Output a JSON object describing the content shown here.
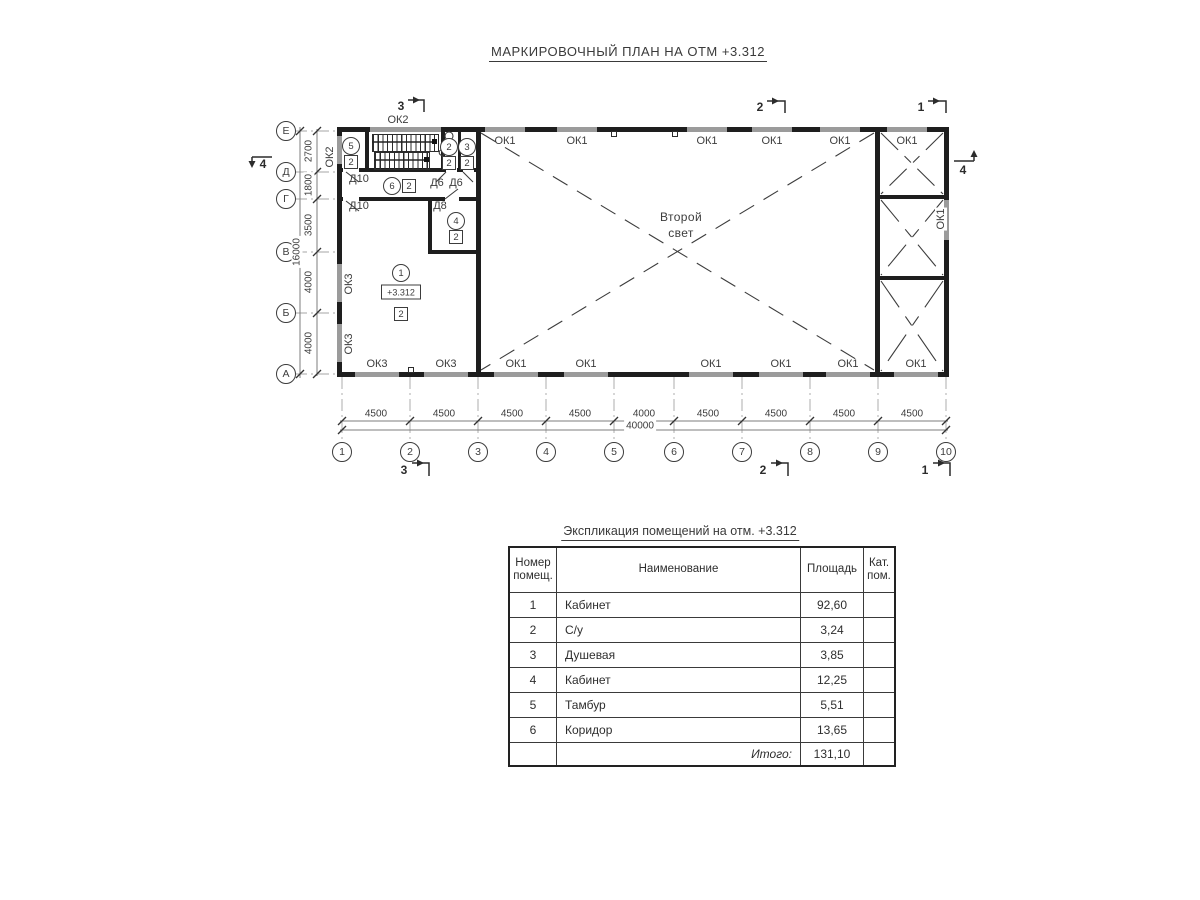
{
  "title": "МАРКИРОВОЧНЫЙ ПЛАН НА ОТМ +3.312",
  "plan": {
    "second_light": {
      "line1": "Второй",
      "line2": "свет"
    },
    "elevation": "+3.312",
    "windows": {
      "ok1": "ОК1",
      "ok2": "ОК2",
      "ok3": "ОК3"
    },
    "doors": {
      "d10": "Д10",
      "d8": "Д8",
      "d6": "Д6"
    },
    "axis_letters": [
      "Е",
      "Д",
      "Г",
      "В",
      "Б",
      "А"
    ],
    "axis_numbers": [
      "1",
      "2",
      "3",
      "4",
      "5",
      "6",
      "7",
      "8",
      "9",
      "10"
    ],
    "left_dims": [
      "2700",
      "1800",
      "3500",
      "4000",
      "4000"
    ],
    "left_total": "16000",
    "bottom_dims": [
      "4500",
      "4500",
      "4500",
      "4500",
      "4000",
      "4500",
      "4500",
      "4500",
      "4500"
    ],
    "bottom_total": "40000",
    "sections": {
      "s1": "1",
      "s2": "2",
      "s3": "3",
      "s4": "4"
    },
    "rooms": [
      {
        "num": "1",
        "cat": "2"
      },
      {
        "num": "2",
        "cat": "2"
      },
      {
        "num": "3",
        "cat": "2"
      },
      {
        "num": "4",
        "cat": "2"
      },
      {
        "num": "5",
        "cat": "2"
      },
      {
        "num": "6",
        "cat": "2"
      }
    ]
  },
  "table": {
    "title": "Экспликация помещений на отм. +3.312",
    "headers": {
      "num1": "Номер",
      "num2": "помещ.",
      "name": "Наименование",
      "area": "Площадь",
      "cat1": "Кат.",
      "cat2": "пом."
    },
    "rows": [
      {
        "num": "1",
        "name": "Кабинет",
        "area": "92,60",
        "cat": ""
      },
      {
        "num": "2",
        "name": "С/у",
        "area": "3,24",
        "cat": ""
      },
      {
        "num": "3",
        "name": "Душевая",
        "area": "3,85",
        "cat": ""
      },
      {
        "num": "4",
        "name": "Кабинет",
        "area": "12,25",
        "cat": ""
      },
      {
        "num": "5",
        "name": "Тамбур",
        "area": "5,51",
        "cat": ""
      },
      {
        "num": "6",
        "name": "Коридор",
        "area": "13,65",
        "cat": ""
      }
    ],
    "total_label": "Итого:",
    "total_area": "131,10"
  }
}
